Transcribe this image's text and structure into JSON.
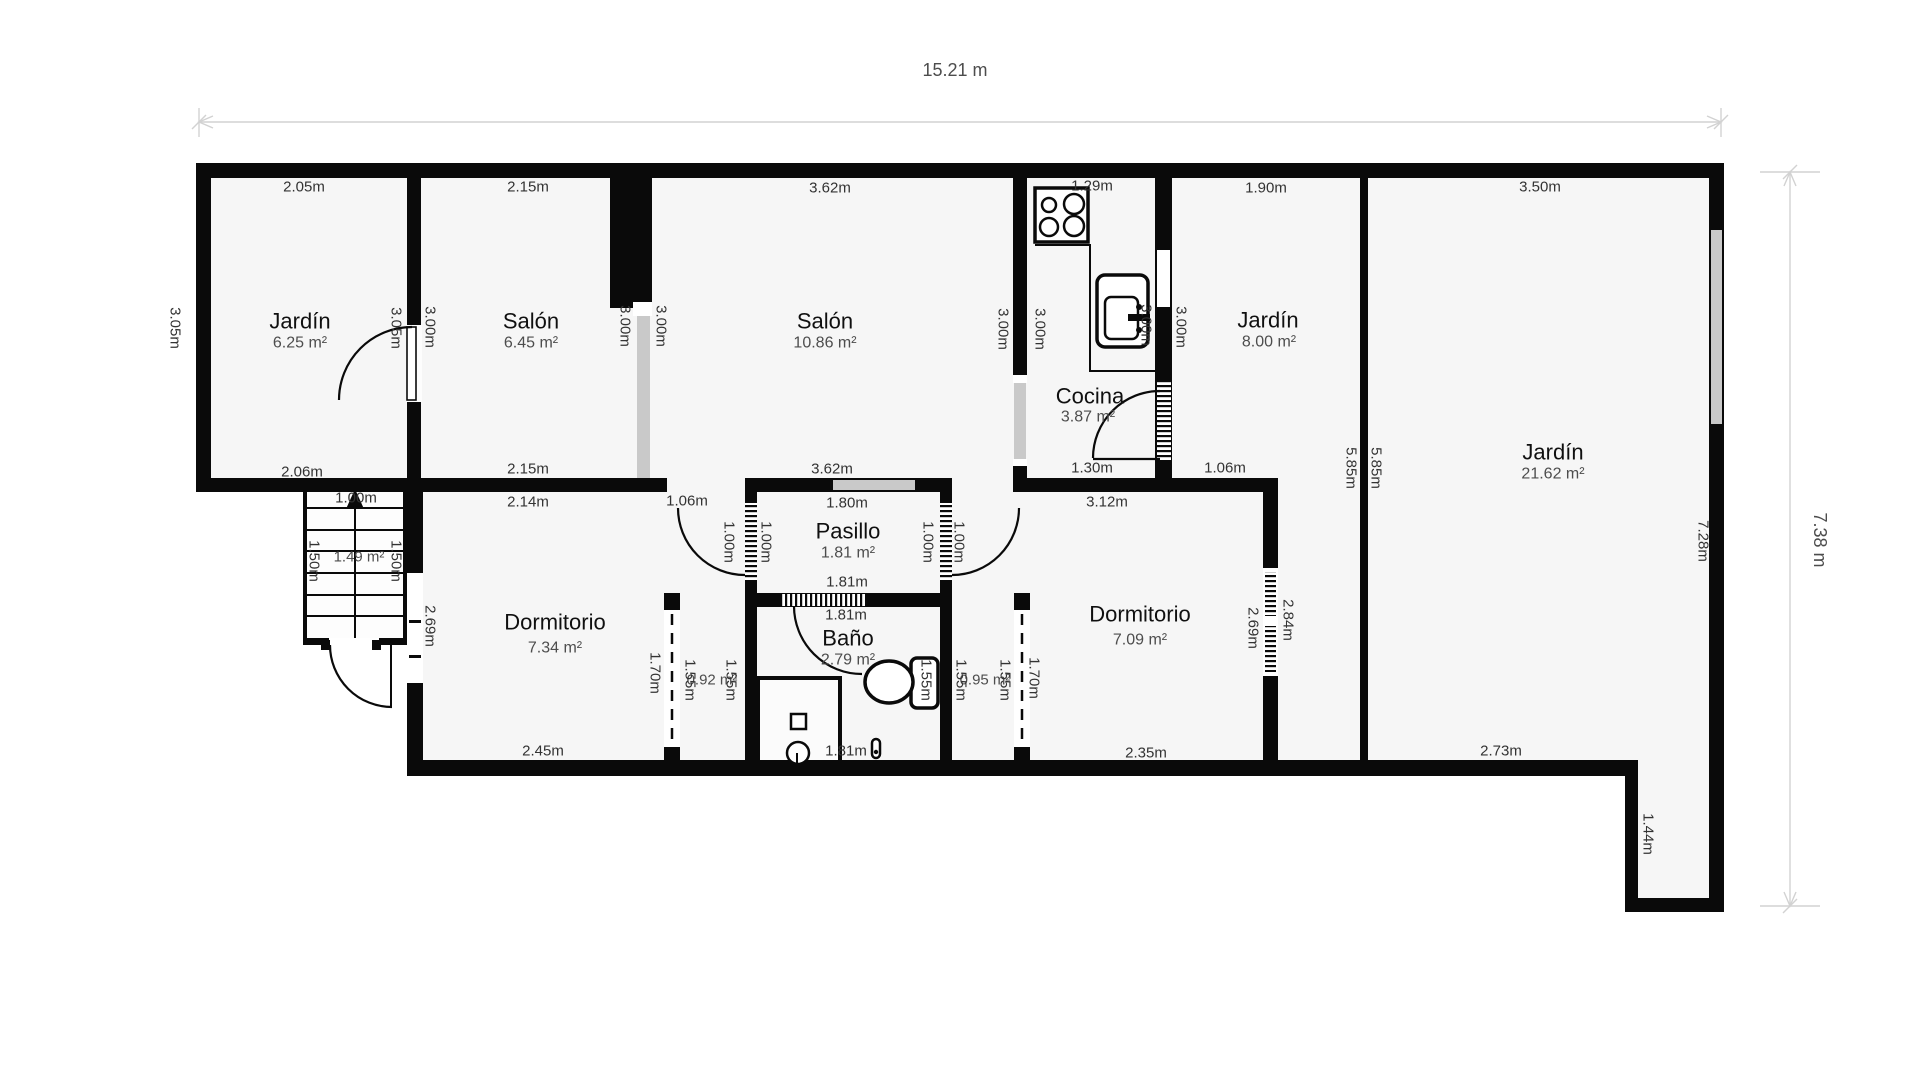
{
  "plan": {
    "total_width": "15.21 m",
    "total_height": "7.38 m"
  },
  "rooms": {
    "jardin_nw": {
      "name": "Jardín",
      "area": "6.25 m²"
    },
    "salon_small": {
      "name": "Salón",
      "area": "6.45 m²"
    },
    "salon_big": {
      "name": "Salón",
      "area": "10.86 m²"
    },
    "cocina": {
      "name": "Cocina",
      "area": "3.87 m²"
    },
    "jardin_mid": {
      "name": "Jardín",
      "area": "8.00 m²"
    },
    "jardin_right": {
      "name": "Jardín",
      "area": "21.62 m²"
    },
    "dormitorio_left": {
      "name": "Dormitorio",
      "area": "7.34 m²"
    },
    "pasillo": {
      "name": "Pasillo",
      "area": "1.81 m²"
    },
    "bano": {
      "name": "Baño",
      "area": "2.79 m²"
    },
    "dormitorio_right": {
      "name": "Dormitorio",
      "area": "7.09 m²"
    },
    "armario_left": {
      "area": "0.92 m²"
    },
    "armario_right": {
      "area": "0.95 m²"
    },
    "escalera": {
      "area": "1.49 m²"
    }
  },
  "dims": {
    "jardin_nw_top": "2.05m",
    "jardin_nw_left": "3.05m",
    "jardin_nw_right": "3.05m",
    "jardin_nw_bottom": "2.06m",
    "salon_small_top": "2.15m",
    "salon_small_left": "3.00m",
    "salon_small_right": "3.00m",
    "salon_small_bottom": "2.15m",
    "salon_big_top": "3.62m",
    "salon_big_left": "3.00m",
    "salon_big_right": "3.00m",
    "salon_big_bottom": "3.62m",
    "cocina_top": "1.29m",
    "cocina_left": "3.00m",
    "cocina_right": "3.00m",
    "cocina_bottom": "1.30m",
    "jardin_mid_top": "1.90m",
    "jardin_mid_left": "3.00m",
    "jardin_mid_bottom": "1.06m",
    "jardin_right_top": "3.50m",
    "jardin_right_left_outer": "5.85m",
    "jardin_right_left_inner": "5.85m",
    "jardin_right_side": "7.28m",
    "jardin_right_bottom": "2.73m",
    "jardin_right_step": "1.44m",
    "stairs_top": "1.00m",
    "stairs_left": "1.50m",
    "stairs_right": "1.50m",
    "dorm_left_top": "2.14m",
    "dorm_left_side": "2.69m",
    "dorm_left_bottom": "2.45m",
    "dorm_left_door": "1.70m",
    "entry_door_left": "1.06m",
    "pasillo_top": "1.80m",
    "pasillo_bottom": "1.81m",
    "pasillo_door_left_outer": "1.00m",
    "pasillo_door_left_inner": "1.00m",
    "pasillo_door_right_inner": "1.00m",
    "pasillo_door_right_outer": "1.00m",
    "bano_top": "1.81m",
    "bano_bottom": "1.81m",
    "bano_right": "1.55m",
    "armario_left_left": "1.55m",
    "armario_left_right": "1.55m",
    "armario_right_left": "1.55m",
    "armario_right_right": "1.55m",
    "armario_right_door": "1.70m",
    "dorm_right_top": "3.12m",
    "dorm_right_bottom": "2.35m",
    "dorm_right_side_inner": "2.69m",
    "dorm_right_side_outer": "2.84m"
  },
  "colors": {
    "wall": "#0a0a0a",
    "floor": "#f6f6f6",
    "window_glass": "#c9c9c9",
    "dimension_line": "#d2d2d2",
    "dim_text": "#333333",
    "area_text": "#4d4d4d"
  }
}
